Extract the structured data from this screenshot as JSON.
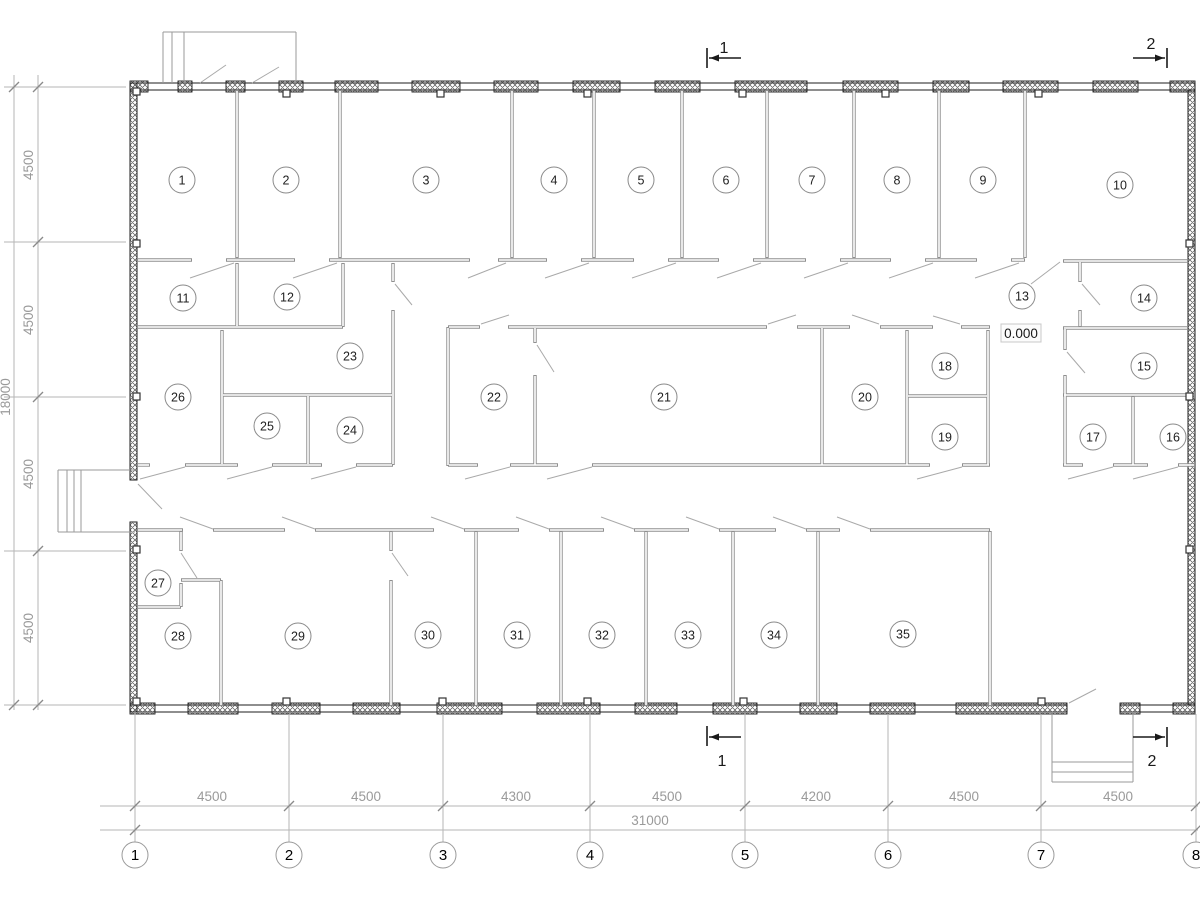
{
  "page": {
    "background": "#ffffff",
    "title": "floor-plan-drawing"
  },
  "plan": {
    "colors": {
      "exterior": "#1c1c1c",
      "hatch": "#555555",
      "partition": "#8f8f8f",
      "swing": "#a9a9a9",
      "stair": "#9a9a9a",
      "extension": "#b6b6b6",
      "tick": "#8a8a8a",
      "dim_text": "#9a9a9a",
      "room_stroke": "#8a8a8a",
      "room_text": "#1f1f1f",
      "axis_stroke": "#9a9a9a",
      "axis_text": "#000000",
      "marker": "#1a1a1a"
    },
    "exterior": {
      "bands": [
        [
          130,
          83,
          1065,
          7
        ],
        [
          130,
          705,
          937,
          7
        ],
        [
          1120,
          705,
          75,
          7
        ]
      ],
      "hatched_walls": [
        [
          130,
          83,
          7,
          397
        ],
        [
          130,
          522,
          7,
          190
        ],
        [
          1188,
          90,
          7,
          615
        ]
      ],
      "windows_top": [
        [
          130,
          148
        ],
        [
          178,
          192
        ],
        [
          226,
          245
        ],
        [
          279,
          303
        ],
        [
          335,
          378
        ],
        [
          412,
          460
        ],
        [
          494,
          538
        ],
        [
          573,
          620
        ],
        [
          655,
          700
        ],
        [
          735,
          807
        ],
        [
          843,
          898
        ],
        [
          933,
          969
        ],
        [
          1003,
          1058
        ],
        [
          1093,
          1138
        ],
        [
          1170,
          1195
        ]
      ],
      "windows_top_y": 81,
      "windows_bottom": [
        [
          130,
          155
        ],
        [
          188,
          238
        ],
        [
          272,
          320
        ],
        [
          353,
          400
        ],
        [
          437,
          502
        ],
        [
          537,
          600
        ],
        [
          635,
          677
        ],
        [
          713,
          757
        ],
        [
          800,
          837
        ],
        [
          870,
          915
        ],
        [
          956,
          1067
        ],
        [
          1120,
          1140
        ],
        [
          1173,
          1195
        ]
      ],
      "windows_bottom_y": 703,
      "window_h": 11
    },
    "partitions": {
      "v": [
        [
          237,
          90,
          258
        ],
        [
          340,
          90,
          258
        ],
        [
          512,
          90,
          258
        ],
        [
          594,
          90,
          258
        ],
        [
          682,
          90,
          258
        ],
        [
          767,
          90,
          258
        ],
        [
          854,
          90,
          258
        ],
        [
          939,
          90,
          258
        ],
        [
          1025,
          90,
          258
        ],
        [
          237,
          263,
          327
        ],
        [
          343,
          263,
          327
        ],
        [
          393,
          263,
          282
        ],
        [
          393,
          310,
          465
        ],
        [
          222,
          330,
          465
        ],
        [
          308,
          395,
          465
        ],
        [
          448,
          327,
          466
        ],
        [
          535,
          327,
          343
        ],
        [
          535,
          375,
          466
        ],
        [
          822,
          327,
          466
        ],
        [
          907,
          330,
          466
        ],
        [
          988,
          330,
          466
        ],
        [
          1065,
          328,
          350
        ],
        [
          1065,
          375,
          466
        ],
        [
          1080,
          261,
          282
        ],
        [
          1080,
          310,
          327
        ],
        [
          1133,
          396,
          466
        ],
        [
          181,
          531,
          551
        ],
        [
          181,
          583,
          607
        ],
        [
          221,
          580,
          706
        ],
        [
          391,
          531,
          551
        ],
        [
          391,
          580,
          706
        ],
        [
          476,
          531,
          706
        ],
        [
          561,
          531,
          706
        ],
        [
          646,
          531,
          706
        ],
        [
          733,
          531,
          706
        ],
        [
          818,
          531,
          706
        ],
        [
          990,
          531,
          706
        ]
      ],
      "h": [
        [
          260,
          137,
          192
        ],
        [
          260,
          226,
          295
        ],
        [
          260,
          329,
          470
        ],
        [
          260,
          498,
          547
        ],
        [
          260,
          581,
          634
        ],
        [
          260,
          668,
          719
        ],
        [
          260,
          753,
          806
        ],
        [
          260,
          840,
          891
        ],
        [
          260,
          925,
          977
        ],
        [
          260,
          1011,
          1025
        ],
        [
          261,
          1063,
          1188
        ],
        [
          327,
          137,
          343
        ],
        [
          327,
          448,
          480
        ],
        [
          327,
          508,
          767
        ],
        [
          327,
          797,
          850
        ],
        [
          327,
          880,
          933
        ],
        [
          327,
          961,
          990
        ],
        [
          328,
          1063,
          1188
        ],
        [
          395,
          222,
          393
        ],
        [
          396,
          907,
          988
        ],
        [
          395,
          1063,
          1195
        ],
        [
          465,
          137,
          150
        ],
        [
          465,
          185,
          238
        ],
        [
          465,
          272,
          322
        ],
        [
          465,
          356,
          393
        ],
        [
          465,
          448,
          478
        ],
        [
          465,
          510,
          558
        ],
        [
          465,
          592,
          930
        ],
        [
          465,
          962,
          990
        ],
        [
          465,
          1063,
          1083
        ],
        [
          465,
          1113,
          1148
        ],
        [
          465,
          1178,
          1195
        ],
        [
          530,
          137,
          183
        ],
        [
          530,
          213,
          285
        ],
        [
          530,
          315,
          434
        ],
        [
          530,
          464,
          519
        ],
        [
          530,
          549,
          604
        ],
        [
          530,
          634,
          689
        ],
        [
          530,
          719,
          776
        ],
        [
          530,
          806,
          840
        ],
        [
          530,
          870,
          990
        ],
        [
          580,
          181,
          221
        ],
        [
          607,
          137,
          181
        ]
      ]
    },
    "door_swings": [
      [
        190,
        278,
        234,
        263
      ],
      [
        293,
        278,
        337,
        263
      ],
      [
        468,
        278,
        506,
        263
      ],
      [
        545,
        278,
        589,
        263
      ],
      [
        632,
        278,
        676,
        263
      ],
      [
        717,
        278,
        761,
        263
      ],
      [
        804,
        278,
        848,
        263
      ],
      [
        889,
        278,
        933,
        263
      ],
      [
        975,
        278,
        1019,
        263
      ],
      [
        1060,
        262,
        1031,
        284
      ],
      [
        200,
        83,
        226,
        65
      ],
      [
        252,
        83,
        279,
        67
      ],
      [
        481,
        324,
        509,
        315
      ],
      [
        768,
        324,
        796,
        315
      ],
      [
        879,
        324,
        852,
        315
      ],
      [
        960,
        324,
        933,
        316
      ],
      [
        185,
        467,
        140,
        479
      ],
      [
        272,
        467,
        227,
        479
      ],
      [
        356,
        467,
        311,
        479
      ],
      [
        510,
        467,
        465,
        479
      ],
      [
        592,
        467,
        547,
        479
      ],
      [
        962,
        467,
        917,
        479
      ],
      [
        1113,
        467,
        1068,
        479
      ],
      [
        1178,
        467,
        1133,
        479
      ],
      [
        213,
        529,
        180,
        517
      ],
      [
        315,
        529,
        282,
        517
      ],
      [
        464,
        529,
        431,
        517
      ],
      [
        549,
        529,
        516,
        517
      ],
      [
        634,
        529,
        601,
        517
      ],
      [
        719,
        529,
        686,
        517
      ],
      [
        806,
        529,
        773,
        517
      ],
      [
        870,
        529,
        837,
        517
      ],
      [
        537,
        345,
        554,
        372
      ],
      [
        1082,
        284,
        1100,
        305
      ],
      [
        1067,
        352,
        1085,
        373
      ],
      [
        395,
        284,
        412,
        305
      ],
      [
        181,
        553,
        197,
        578
      ],
      [
        392,
        553,
        408,
        576
      ],
      [
        138,
        484,
        162,
        509
      ],
      [
        1069,
        703,
        1096,
        689
      ]
    ],
    "stairs": [
      [
        163,
        32,
        296,
        32
      ],
      [
        163,
        32,
        163,
        83
      ],
      [
        296,
        32,
        296,
        83
      ],
      [
        172,
        32,
        172,
        83
      ],
      [
        184,
        32,
        184,
        83
      ],
      [
        58,
        470,
        135,
        470
      ],
      [
        58,
        470,
        58,
        532
      ],
      [
        58,
        532,
        135,
        532
      ],
      [
        67,
        470,
        67,
        532
      ],
      [
        74,
        470,
        74,
        532
      ],
      [
        81,
        470,
        81,
        532
      ],
      [
        1052,
        712,
        1052,
        782
      ],
      [
        1133,
        712,
        1133,
        782
      ],
      [
        1052,
        782,
        1133,
        782
      ],
      [
        1052,
        762,
        1133,
        762
      ],
      [
        1052,
        772,
        1133,
        772
      ]
    ],
    "column_tabs": [
      [
        283,
        90
      ],
      [
        437,
        90
      ],
      [
        584,
        90
      ],
      [
        739,
        90
      ],
      [
        882,
        90
      ],
      [
        1035,
        90
      ],
      [
        283,
        698
      ],
      [
        439,
        698
      ],
      [
        584,
        698
      ],
      [
        740,
        698
      ],
      [
        1038,
        698
      ],
      [
        133,
        88
      ],
      [
        133,
        240
      ],
      [
        133,
        393
      ],
      [
        133,
        546
      ],
      [
        133,
        698
      ],
      [
        1186,
        240
      ],
      [
        1186,
        393
      ],
      [
        1186,
        546
      ]
    ],
    "rooms": [
      {
        "n": "1",
        "x": 182,
        "y": 180
      },
      {
        "n": "2",
        "x": 286,
        "y": 180
      },
      {
        "n": "3",
        "x": 426,
        "y": 180
      },
      {
        "n": "4",
        "x": 554,
        "y": 180
      },
      {
        "n": "5",
        "x": 641,
        "y": 180
      },
      {
        "n": "6",
        "x": 726,
        "y": 180
      },
      {
        "n": "7",
        "x": 812,
        "y": 180
      },
      {
        "n": "8",
        "x": 897,
        "y": 180
      },
      {
        "n": "9",
        "x": 983,
        "y": 180
      },
      {
        "n": "10",
        "x": 1120,
        "y": 185
      },
      {
        "n": "11",
        "x": 183,
        "y": 298
      },
      {
        "n": "12",
        "x": 287,
        "y": 297
      },
      {
        "n": "13",
        "x": 1022,
        "y": 296
      },
      {
        "n": "14",
        "x": 1144,
        "y": 298
      },
      {
        "n": "15",
        "x": 1144,
        "y": 366
      },
      {
        "n": "16",
        "x": 1173,
        "y": 437
      },
      {
        "n": "17",
        "x": 1093,
        "y": 437
      },
      {
        "n": "18",
        "x": 945,
        "y": 366
      },
      {
        "n": "19",
        "x": 945,
        "y": 437
      },
      {
        "n": "20",
        "x": 865,
        "y": 397
      },
      {
        "n": "21",
        "x": 664,
        "y": 397
      },
      {
        "n": "22",
        "x": 494,
        "y": 397
      },
      {
        "n": "23",
        "x": 350,
        "y": 356
      },
      {
        "n": "24",
        "x": 350,
        "y": 430
      },
      {
        "n": "25",
        "x": 267,
        "y": 426
      },
      {
        "n": "26",
        "x": 178,
        "y": 397
      },
      {
        "n": "27",
        "x": 158,
        "y": 583
      },
      {
        "n": "28",
        "x": 178,
        "y": 636
      },
      {
        "n": "29",
        "x": 298,
        "y": 636
      },
      {
        "n": "30",
        "x": 428,
        "y": 635
      },
      {
        "n": "31",
        "x": 517,
        "y": 635
      },
      {
        "n": "32",
        "x": 602,
        "y": 635
      },
      {
        "n": "33",
        "x": 688,
        "y": 635
      },
      {
        "n": "34",
        "x": 774,
        "y": 635
      },
      {
        "n": "35",
        "x": 903,
        "y": 634
      }
    ],
    "room_radius": 13,
    "grid": {
      "bubbles": [
        {
          "label": "1",
          "x": 135
        },
        {
          "label": "2",
          "x": 289
        },
        {
          "label": "3",
          "x": 443
        },
        {
          "label": "4",
          "x": 590
        },
        {
          "label": "5",
          "x": 745
        },
        {
          "label": "6",
          "x": 888
        },
        {
          "label": "7",
          "x": 1041
        },
        {
          "label": "8",
          "x": 1196
        }
      ],
      "cy": 855,
      "r": 13
    },
    "dimensions": {
      "bottom": {
        "line1_y": 806,
        "line2_y": 830,
        "x_start": 100,
        "x_end": 1198,
        "labels": [
          {
            "t": "4500",
            "x": 212
          },
          {
            "t": "4500",
            "x": 366
          },
          {
            "t": "4300",
            "x": 516
          },
          {
            "t": "4500",
            "x": 667
          },
          {
            "t": "4200",
            "x": 816
          },
          {
            "t": "4500",
            "x": 964
          },
          {
            "t": "4500",
            "x": 1118
          }
        ],
        "label_y": 801,
        "total": {
          "t": "31000",
          "x": 650,
          "y": 825
        },
        "ticks1_x": [
          135,
          289,
          443,
          590,
          745,
          888,
          1041,
          1196
        ],
        "ticks2_x": [
          135,
          1196
        ],
        "ext_y1": 714,
        "ext_y2": 842
      },
      "left": {
        "lineA_x": 38,
        "lineB_x": 14,
        "y_start": 75,
        "y_end": 710,
        "ticks_y": [
          87,
          242,
          397,
          551,
          705
        ],
        "ticksB_y": [
          87,
          705
        ],
        "labels": [
          {
            "t": "4500",
            "y": 165
          },
          {
            "t": "4500",
            "y": 320
          },
          {
            "t": "4500",
            "y": 474
          },
          {
            "t": "4500",
            "y": 628
          }
        ],
        "label_x": 33,
        "total": {
          "t": "18000",
          "x": 10,
          "y": 397
        },
        "ext_x1": 4,
        "ext_x2": 126
      }
    },
    "section_markers": [
      {
        "label": "1",
        "vline": [
          707,
          48,
          707,
          68
        ],
        "hline": [
          709,
          58,
          741,
          58
        ],
        "arrow": [
          710,
          58,
          "left"
        ],
        "pos": [
          724,
          53
        ]
      },
      {
        "label": "2",
        "vline": [
          1167,
          48,
          1167,
          68
        ],
        "hline": [
          1133,
          58,
          1165,
          58
        ],
        "arrow": [
          1164,
          58,
          "right"
        ],
        "pos": [
          1151,
          49
        ]
      },
      {
        "label": "1",
        "vline": [
          707,
          726,
          707,
          746
        ],
        "hline": [
          709,
          737,
          741,
          737
        ],
        "arrow": [
          710,
          737,
          "left"
        ],
        "pos": [
          722,
          766
        ]
      },
      {
        "label": "2",
        "vline": [
          1167,
          727,
          1167,
          747
        ],
        "hline": [
          1133,
          737,
          1165,
          737
        ],
        "arrow": [
          1164,
          737,
          "right"
        ],
        "pos": [
          1152,
          766
        ]
      }
    ],
    "elevation": {
      "text": "0.000",
      "box": [
        1001,
        324,
        40,
        18
      ],
      "text_pos": [
        1021,
        338
      ]
    }
  }
}
